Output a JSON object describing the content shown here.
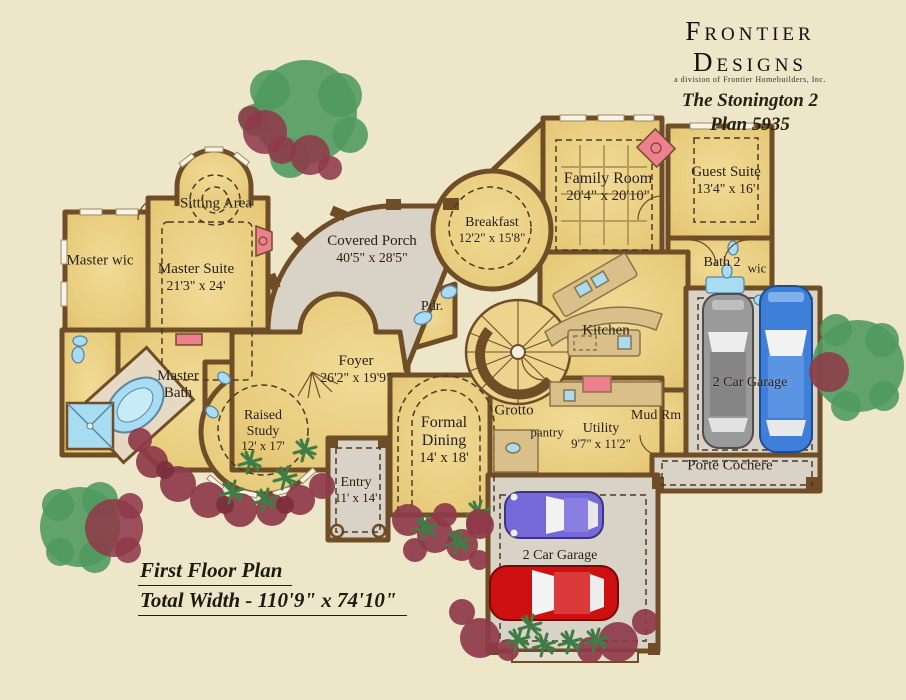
{
  "title_block": {
    "brand": "Frontier Designs",
    "brand_sub": "a division of Frontier Homebuilders, Inc.",
    "plan_name": "The Stonington 2",
    "plan_number": "Plan 5935"
  },
  "rooms": {
    "sitting_area": {
      "label": "Sitting Area"
    },
    "master_wic": {
      "label": "Master wic"
    },
    "master_suite": {
      "label": "Master Suite",
      "dims": "21'3\" x 24'"
    },
    "covered_porch": {
      "label": "Covered Porch",
      "dims": "40'5\" x 28'5\""
    },
    "breakfast": {
      "label": "Breakfast",
      "dims": "12'2\" x 15'8\""
    },
    "family_room": {
      "label": "Family Room",
      "dims": "20'4\" x 20'10\""
    },
    "guest_suite": {
      "label": "Guest Suite",
      "dims": "13'4\" x 16'"
    },
    "bath_2": {
      "label": "Bath 2"
    },
    "wic": {
      "label": "wic"
    },
    "powder": {
      "label": "Pdr."
    },
    "kitchen": {
      "label": "Kitchen"
    },
    "foyer": {
      "label": "Foyer",
      "dims": "26'2\" x 19'9\""
    },
    "master_bath": {
      "label": "Master Bath"
    },
    "raised_study": {
      "label": "Raised Study",
      "dims": "12' x 17'"
    },
    "formal_dining": {
      "label": "Formal Dining",
      "dims": "14' x 18'"
    },
    "grotto": {
      "label": "Grotto"
    },
    "pantry": {
      "label": "pantry"
    },
    "utility": {
      "label": "Utility",
      "dims": "9'7\" x 11'2\""
    },
    "mud_room": {
      "label": "Mud Rm"
    },
    "garage_right": {
      "label": "2 Car Garage"
    },
    "porte_cochere": {
      "label": "Porte Cochere"
    },
    "entry": {
      "label": "Entry",
      "dims": "11' x 14'"
    },
    "garage_bottom": {
      "label": "2 Car Garage"
    }
  },
  "footer": {
    "line1": "First Floor Plan",
    "line2": "Total Width - 110'9\" x 74'10\""
  },
  "palette": {
    "page_bg": "#EDE6C9",
    "floor_gold": "#E8CB7C",
    "wall_brown": "#6F4E27",
    "porch_gray": "#D9D2C6",
    "counter_tan": "#D9C08A",
    "tree_green": "#4E9A5F",
    "shrub_maroon": "#8E3A4A",
    "accent_pink": "#EE7F8E",
    "fixture_blue": "#A8DCF2",
    "car_gray": "#9A9A9A",
    "car_blue": "#3D7FD9",
    "car_purple": "#7568D8",
    "car_red": "#CE1010",
    "text": "#262015"
  }
}
